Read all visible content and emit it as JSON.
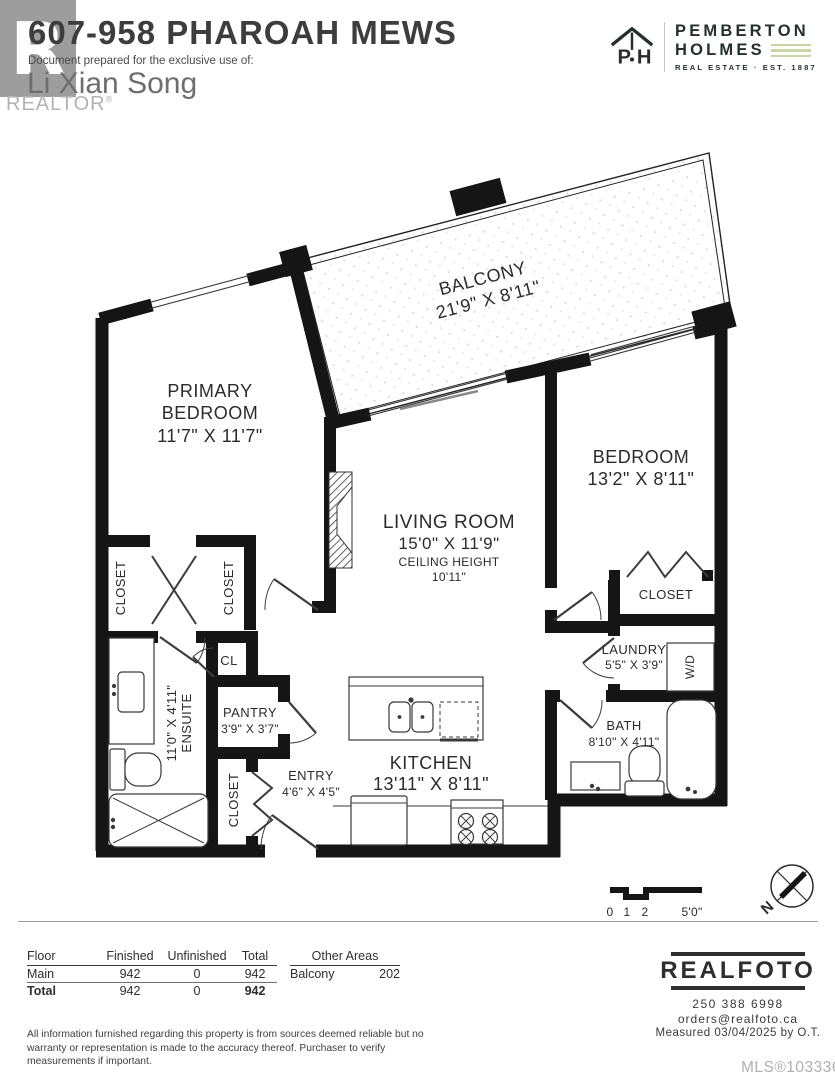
{
  "header": {
    "title": "607-958 PHAROAH MEWS",
    "prepared_for_label": "Document prepared for the exclusive use of:",
    "prepared_for_name": "Li Xian Song",
    "realtor_mark": "REALTOR",
    "realtor_logo_letter": "R",
    "brand": {
      "name_line1": "PEMBERTON",
      "name_line2": "HOLMES",
      "icon_letters": "P·H",
      "tagline_left": "REAL ESTATE",
      "tagline_dot": "•",
      "tagline_right": "EST. 1887",
      "dark_green": "#22322b",
      "light_green": "#c8d6a2"
    }
  },
  "plan": {
    "rooms": {
      "balcony": {
        "name": "BALCONY",
        "dims": "21'9\" X 8'11\""
      },
      "primary": {
        "name1": "PRIMARY",
        "name2": "BEDROOM",
        "dims": "11'7\" X 11'7\""
      },
      "bedroom": {
        "name": "BEDROOM",
        "dims": "13'2\" X 8'11\""
      },
      "living": {
        "name": "LIVING ROOM",
        "dims": "15'0\" X 11'9\"",
        "ceiling_label": "CEILING HEIGHT",
        "ceiling_value": "10'11\""
      },
      "kitchen": {
        "name": "KITCHEN",
        "dims": "13'11\" X 8'11\""
      },
      "ensuite": {
        "name": "ENSUITE",
        "dims": "11'0\" X 4'11\""
      },
      "pantry": {
        "name": "PANTRY",
        "dims": "3'9\" X 3'7\""
      },
      "entry": {
        "name": "ENTRY",
        "dims": "4'6\" X 4'5\""
      },
      "laundry": {
        "name": "LAUNDRY",
        "dims": "5'5\" X 3'9\""
      },
      "bath": {
        "name": "BATH",
        "dims": "8'10\" X 4'11\""
      }
    },
    "labels": {
      "closet": "CLOSET",
      "cl": "CL",
      "wd": "W/D",
      "north": "N"
    },
    "scale": {
      "tick0": "0",
      "tick1": "1",
      "tick2": "2",
      "tick3": "5'0\""
    },
    "wall_color": "#151515"
  },
  "footer": {
    "table": {
      "headers": [
        "Floor",
        "Finished",
        "Unfinished",
        "Total"
      ],
      "rows": [
        {
          "floor": "Main",
          "finished": "942",
          "unfinished": "0",
          "total": "942"
        },
        {
          "floor": "Total",
          "finished": "942",
          "unfinished": "0",
          "total": "942"
        }
      ],
      "other_areas_header": "Other Areas",
      "other_areas": [
        {
          "name": "Balcony",
          "value": "202"
        }
      ]
    },
    "disclaimer": "All information furnished regarding this property is from sources deemed reliable but no warranty or representation is made to the accuracy thereof. Purchaser to verify measurements if important.",
    "realfoto": {
      "logo": "REALFOTO",
      "phone": "250 388 6998",
      "email": "orders@realfoto.ca",
      "measured": "Measured 03/04/2025 by O.T.",
      "mls": "MLS®1033367"
    }
  }
}
